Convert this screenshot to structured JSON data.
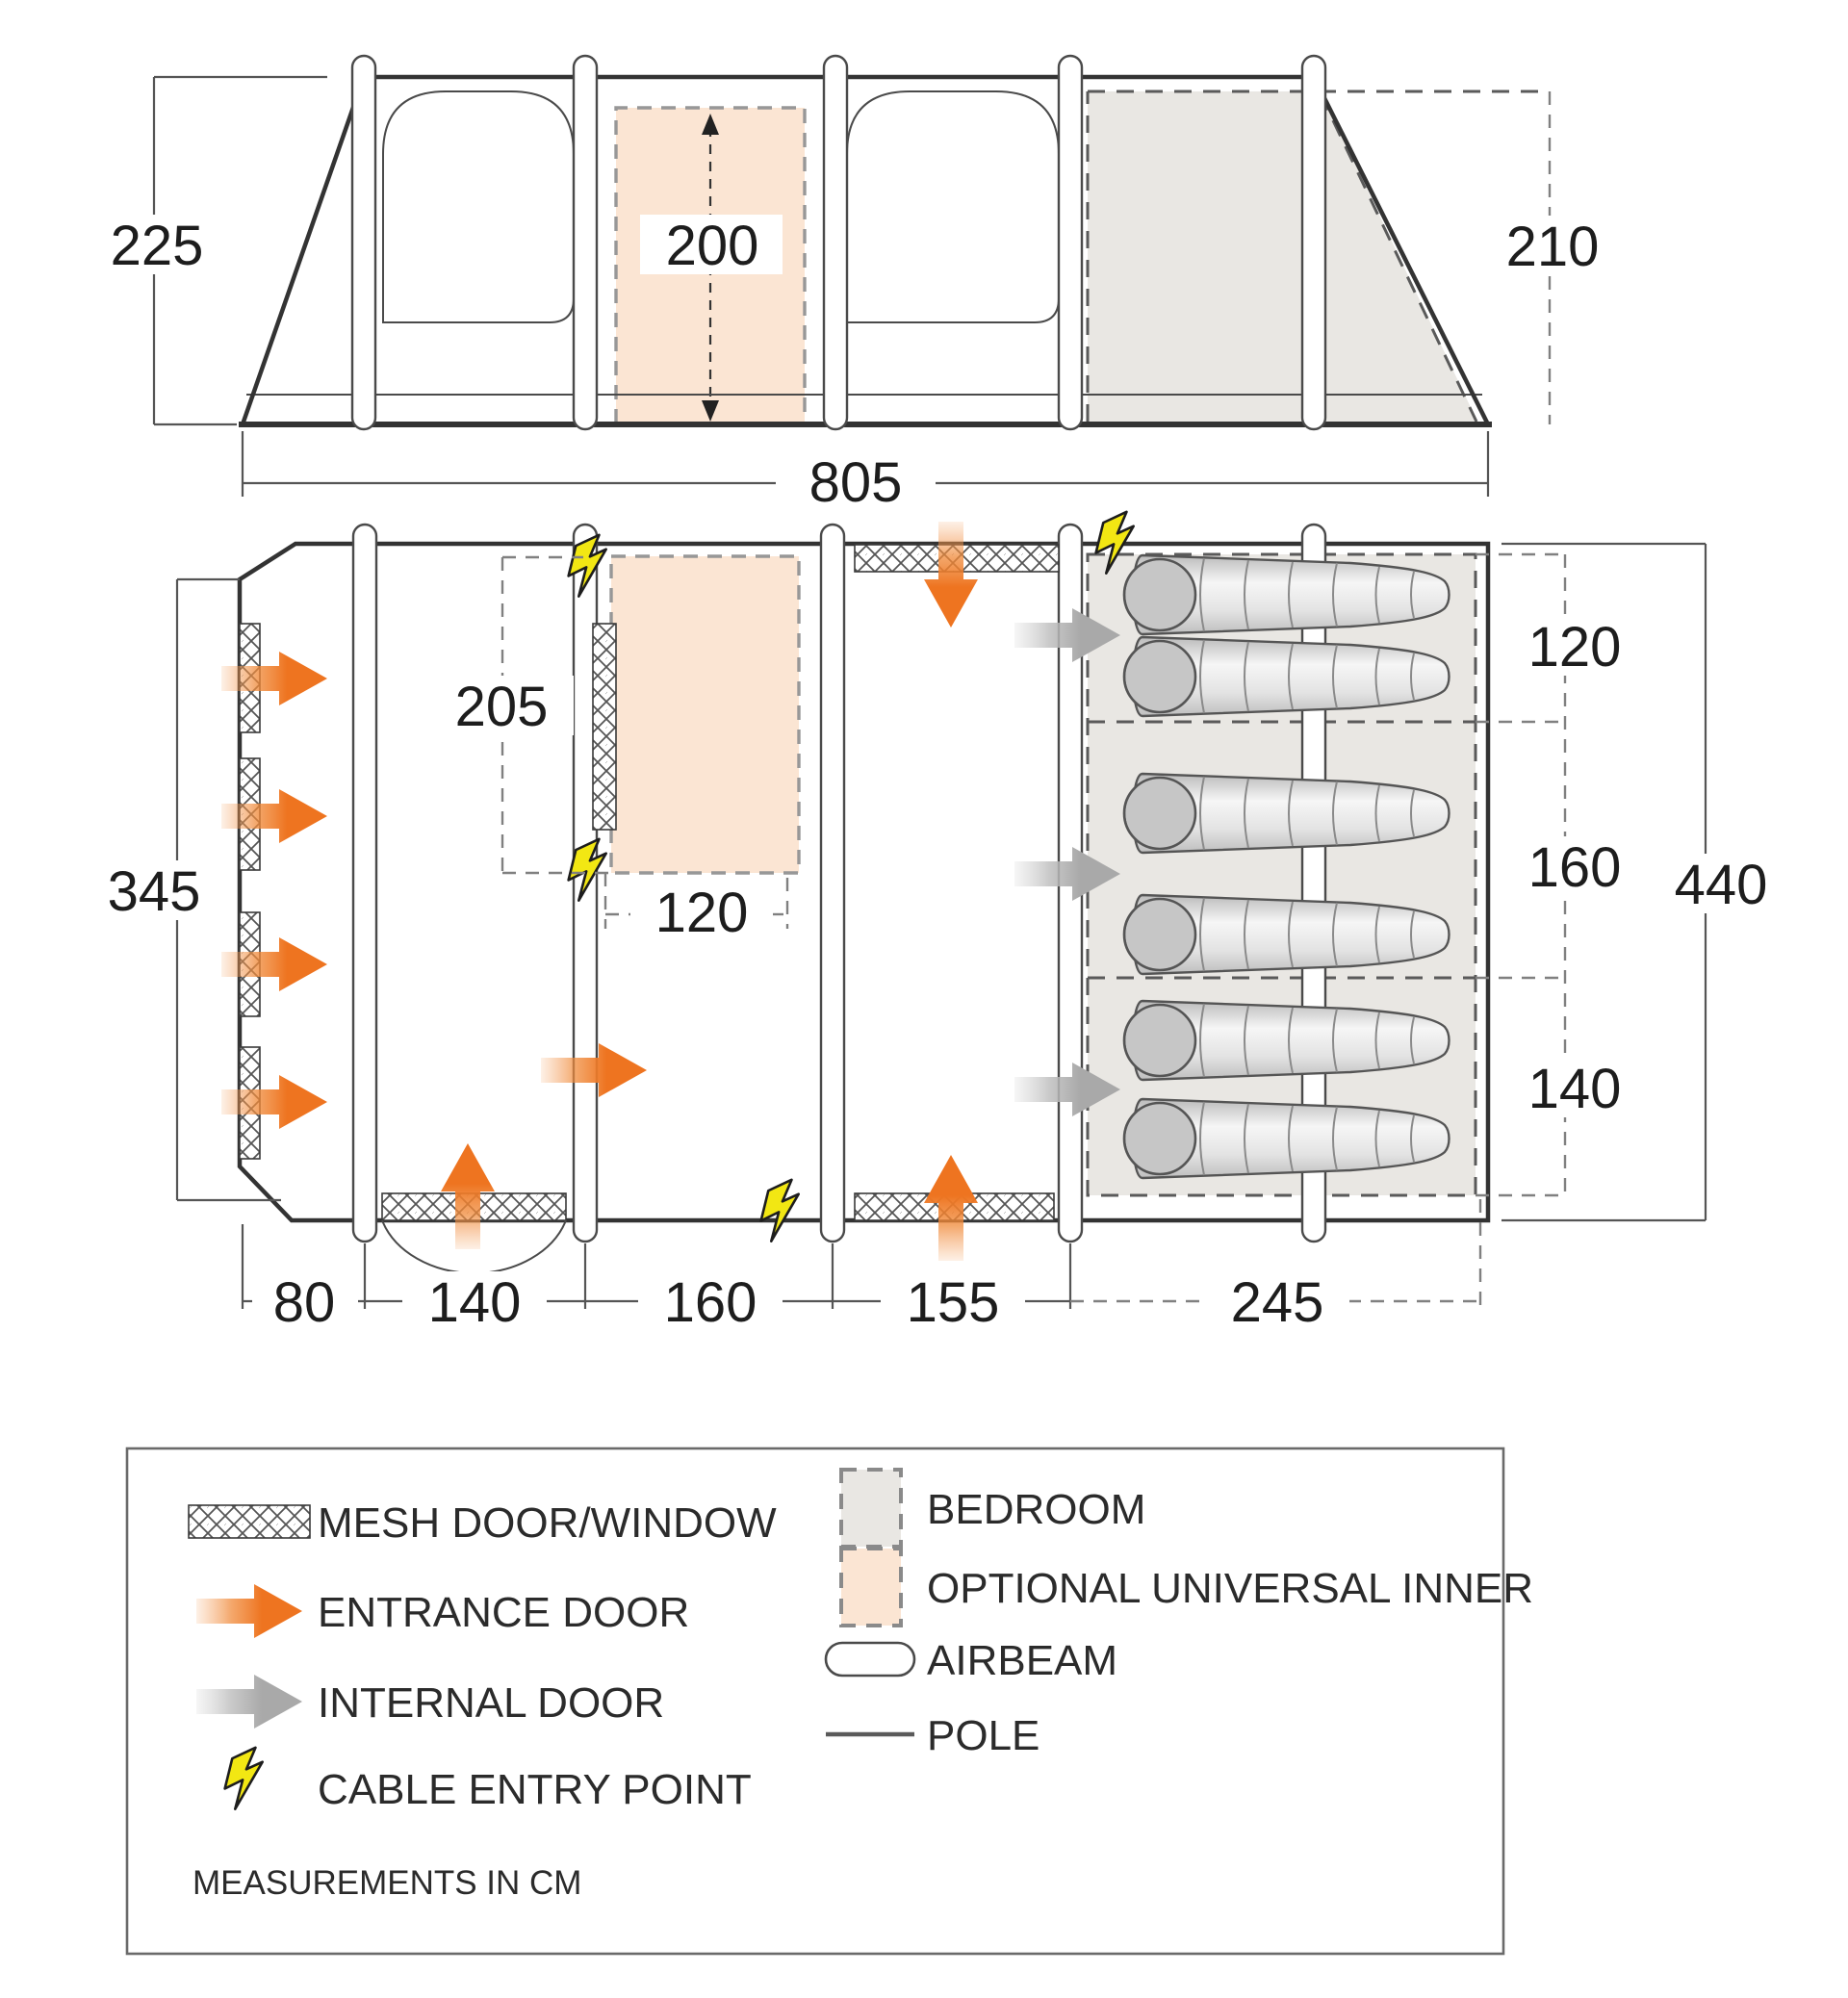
{
  "title": "tent-floorplan-diagram",
  "units_note": "MEASUREMENTS IN CM",
  "dims": {
    "elev_left_height": "225",
    "elev_inner_height": "200",
    "elev_rear_height": "210",
    "total_length": "805",
    "front_depth": "345",
    "inner_length": "205",
    "inner_width": "120",
    "bed_section_1": "120",
    "bed_section_2": "160",
    "bed_section_3": "140",
    "total_depth": "440",
    "bottom_section_1": "80",
    "bottom_section_2": "140",
    "bottom_section_3": "160",
    "bottom_section_4": "155",
    "bottom_section_5": "245"
  },
  "legend": {
    "mesh": "MESH DOOR/WINDOW",
    "entrance": "ENTRANCE DOOR",
    "internal": "INTERNAL DOOR",
    "cable": "CABLE ENTRY POINT",
    "bedroom": "BEDROOM",
    "optional": "OPTIONAL UNIVERSAL INNER",
    "airbeam": "AIRBEAM",
    "pole": "POLE",
    "note": "MEASUREMENTS IN CM"
  },
  "colors": {
    "entrance_arrow": "#ee7420",
    "internal_arrow": "#a9a9a9",
    "optional_inner_fill": "#fbe5d3",
    "bedroom_fill": "#e9e7e3",
    "cable_yellow": "#f2e713",
    "line": "#333333"
  },
  "counts": {
    "sleeping_bags": 6,
    "airbeams": 5,
    "cable_entry_points": 4
  }
}
